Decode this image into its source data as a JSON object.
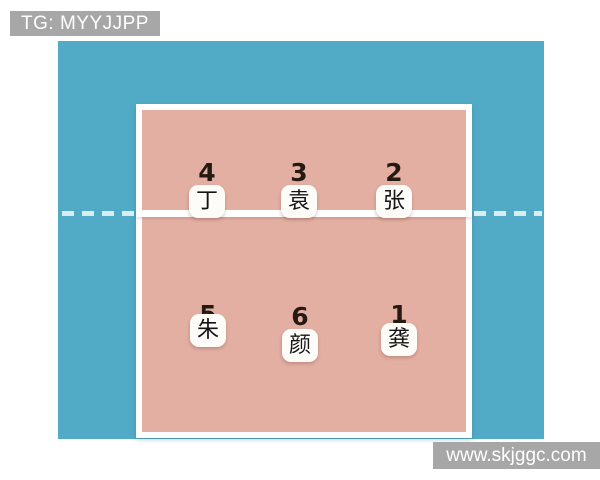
{
  "overlay": {
    "tg_label": "TG: MYYJJPP",
    "watermark": "www.skjggc.com"
  },
  "court": {
    "description": "volleyball-rotation-diagram",
    "front_row": [
      {
        "position": "4",
        "player": "丁"
      },
      {
        "position": "3",
        "player": "袁"
      },
      {
        "position": "2",
        "player": "张"
      }
    ],
    "back_row": [
      {
        "position": "5",
        "player": "朱"
      },
      {
        "position": "6",
        "player": "颜"
      },
      {
        "position": "1",
        "player": "龚"
      }
    ]
  },
  "colors": {
    "background_blue": "#51abc7",
    "court_pink": "#e4afa3",
    "line_white": "#ffffff",
    "label_gray": "#a7a7a7",
    "number_dark": "#241a12",
    "dash_light": "#d8eef2"
  }
}
